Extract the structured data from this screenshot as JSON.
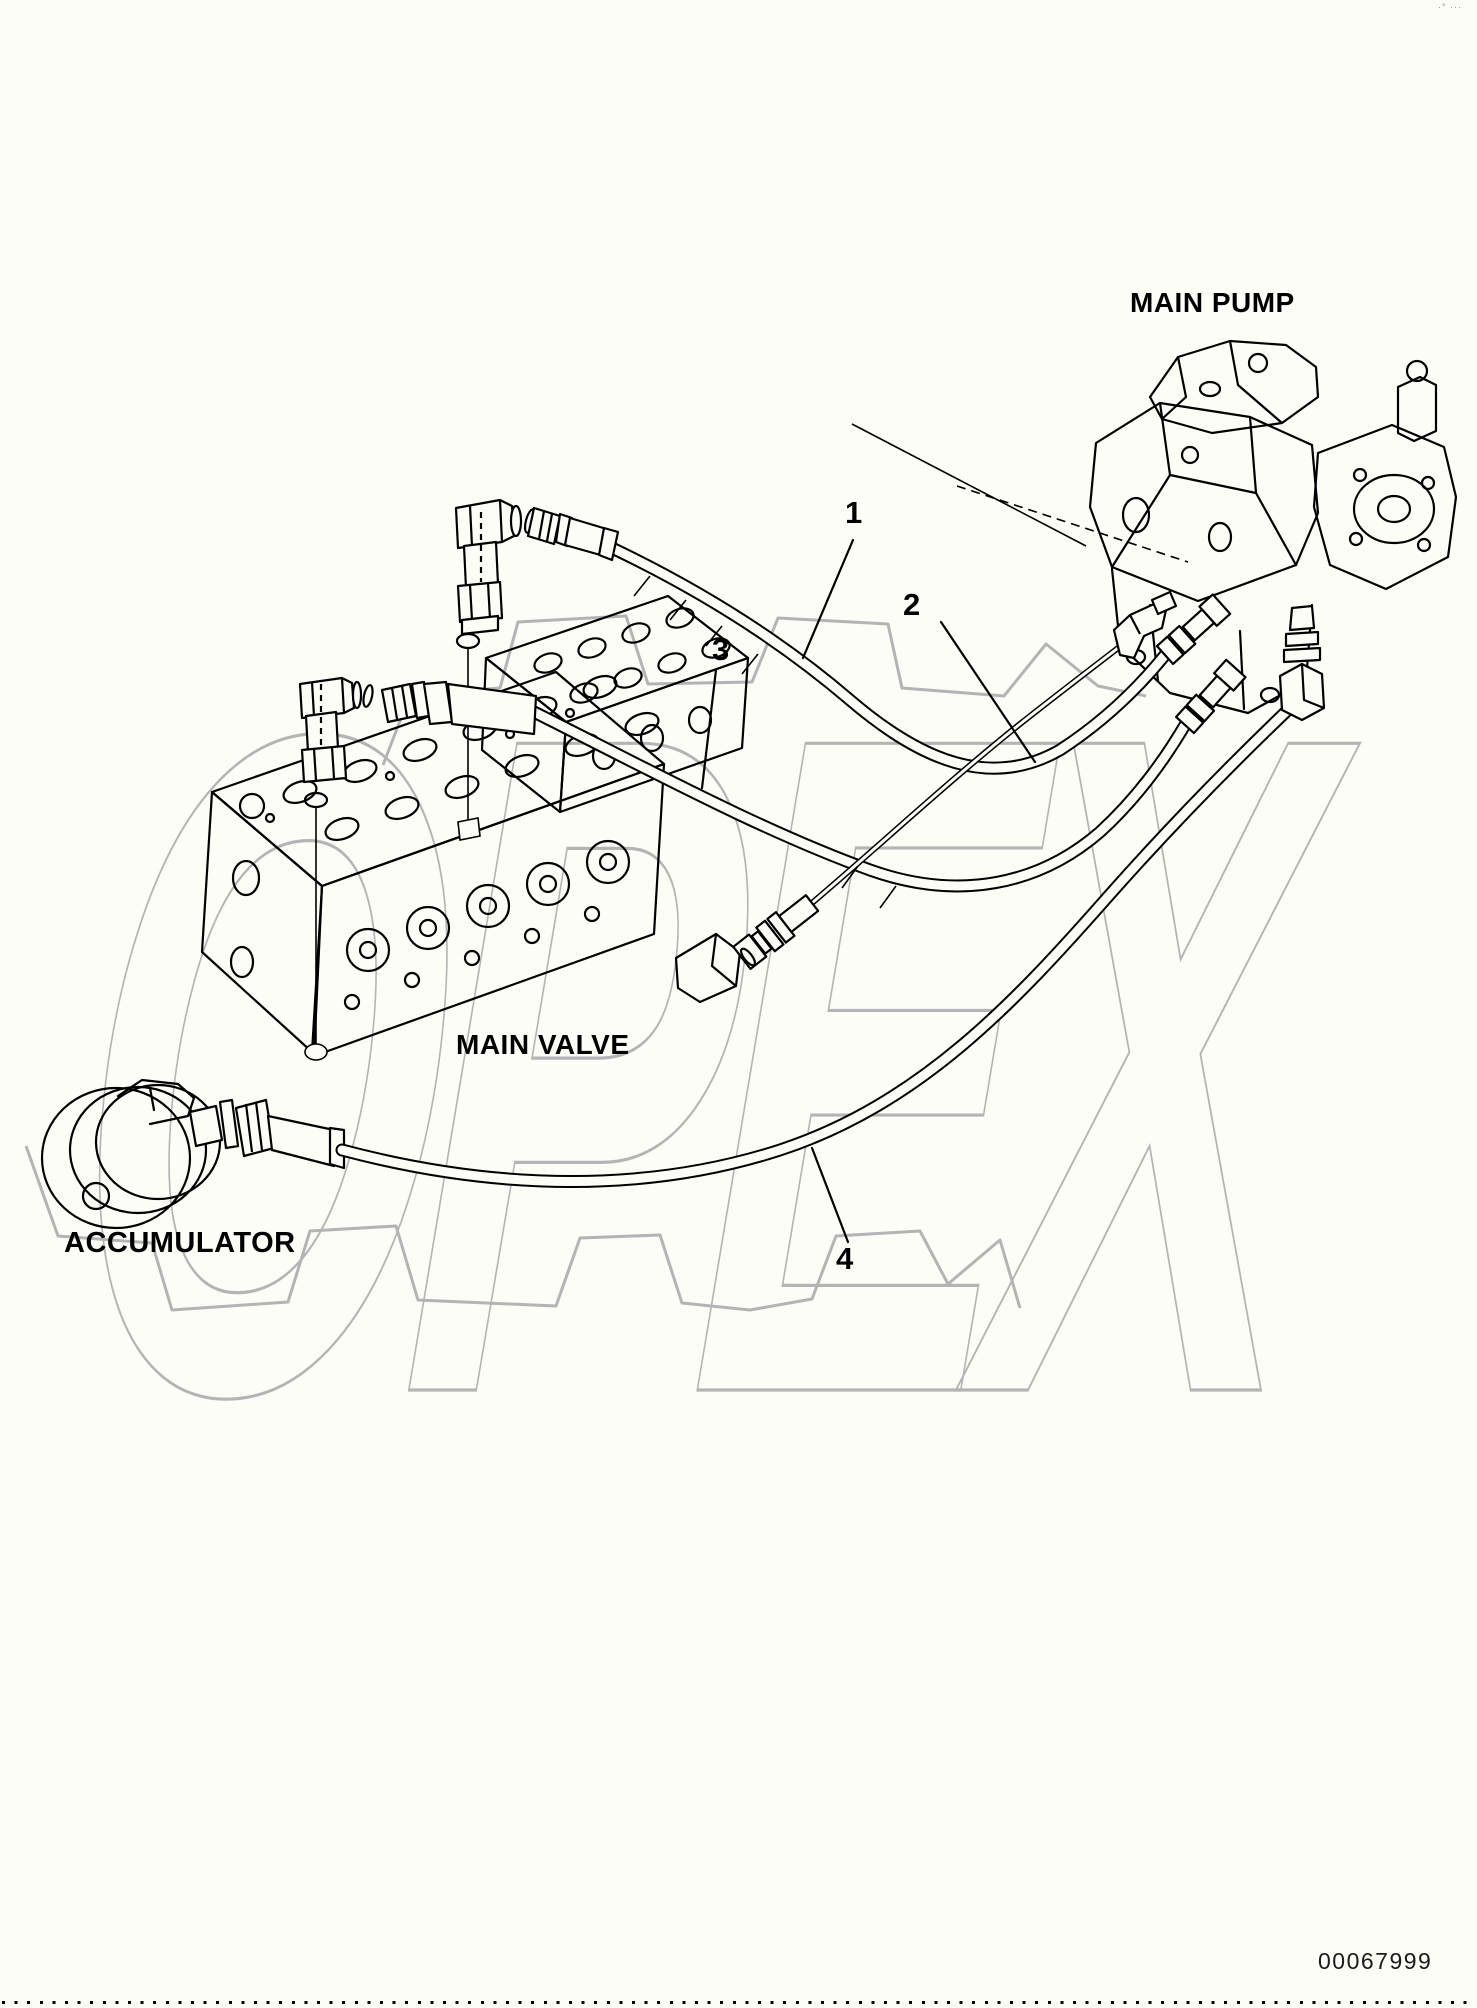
{
  "labels": {
    "main_pump": "MAIN PUMP",
    "main_valve": "MAIN VALVE",
    "accumulator": "ACCUMULATOR"
  },
  "callouts": {
    "c1": "1",
    "c2": "2",
    "c3": "3",
    "c4": "4"
  },
  "footer": {
    "drawing_number": "00067999"
  },
  "header": {
    "corner_marks": "·° ···"
  },
  "watermark": {
    "text": "OPEX"
  },
  "colors": {
    "line": "#000000",
    "watermark": "#b4b4b4",
    "text": "#000000",
    "drawing_number": "#1a1a1a",
    "background": "#fcfdf7"
  }
}
